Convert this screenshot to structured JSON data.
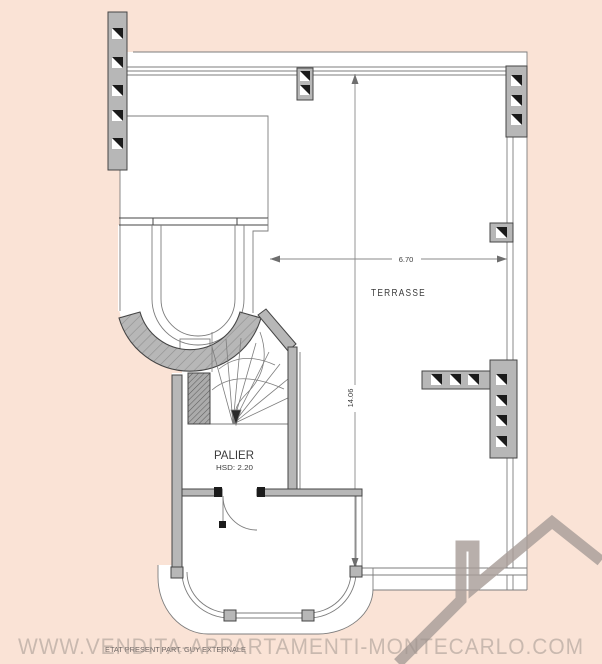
{
  "colors": {
    "bg": "#fae3d6",
    "white": "#ffffff",
    "wall": "#b7b7b7",
    "line": "#454545",
    "thin": "#7d7d7d",
    "dark": "#1b1b1b",
    "text": "#3c3c3c",
    "watermark": "#9e938d",
    "logo": "#a89e99"
  },
  "plan": {
    "terrace_label": "TERRASSE",
    "palier_label": "PALIER",
    "palier_height": "HSD: 2.20",
    "dim_width": "6.70",
    "dim_height": "14.06"
  },
  "watermark": {
    "site": "WWW.VENDITA-APPARTAMENTI-MONTECARLO.COM",
    "note": "ETAT PRESENT PART. GUY EXTERNALE"
  }
}
